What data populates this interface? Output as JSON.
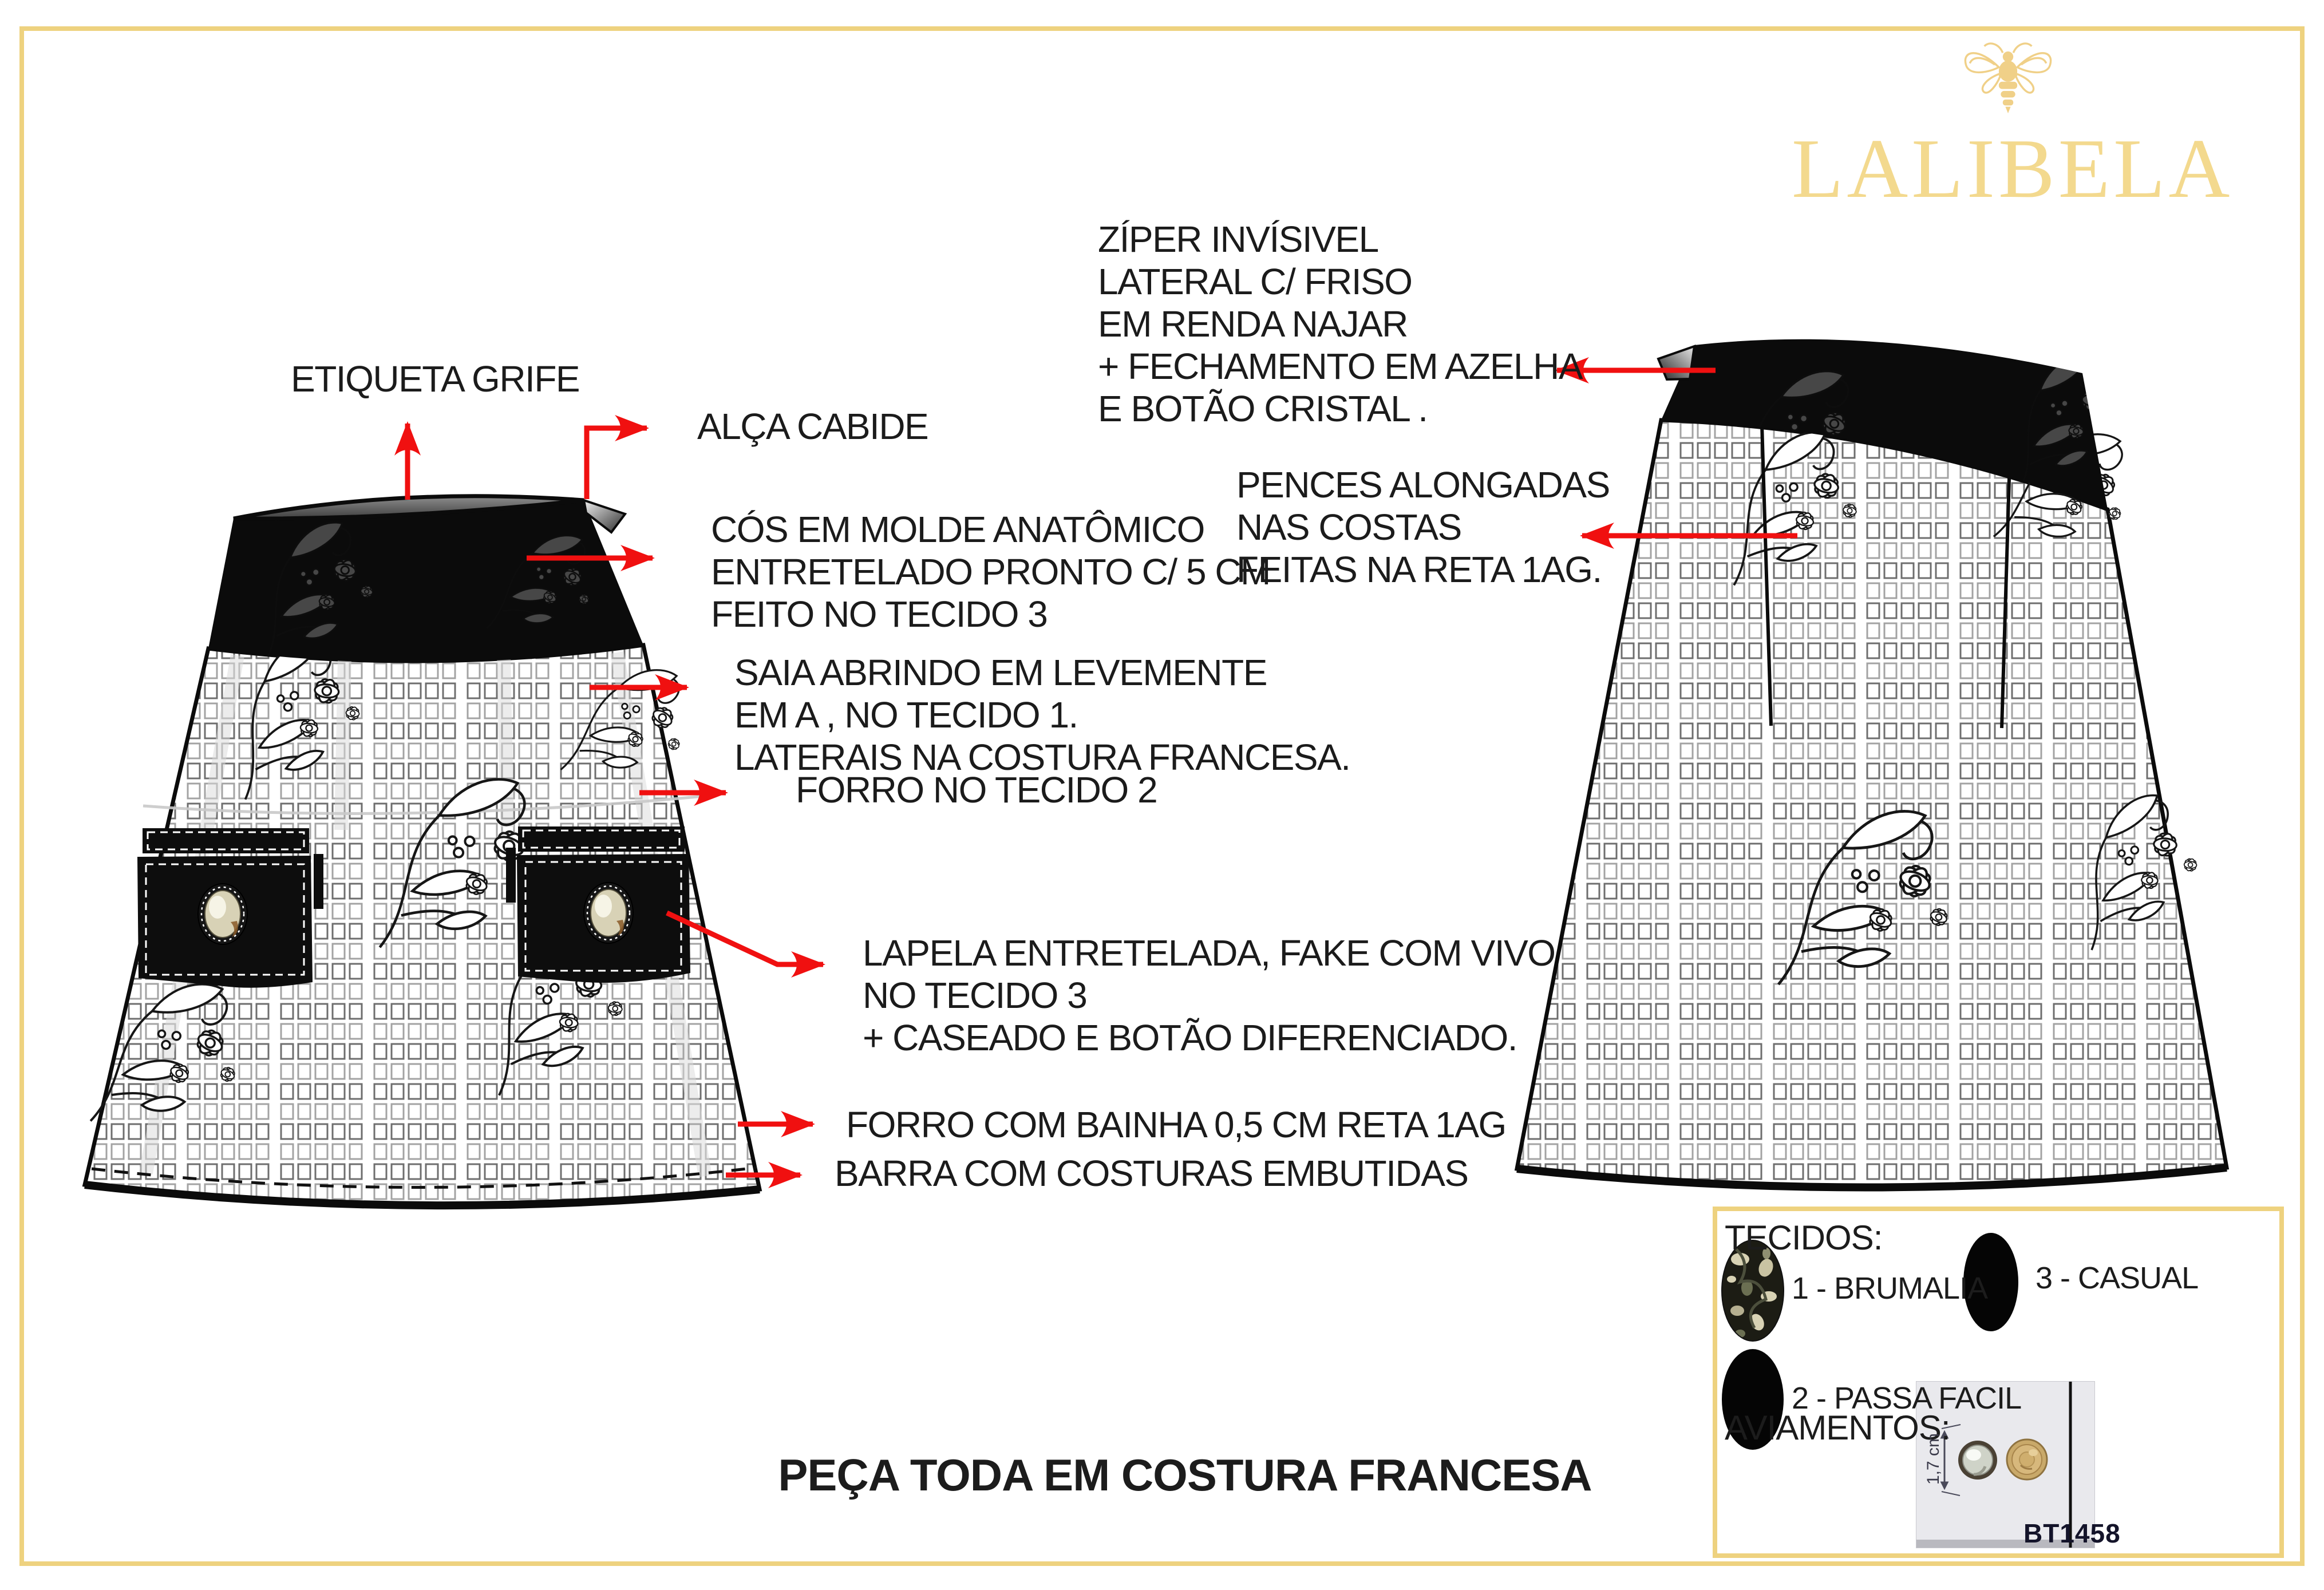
{
  "brand": {
    "name": "LALIBELA",
    "icon": "bee-icon",
    "gold": "#f3d98e"
  },
  "colors": {
    "arrow_red": "#f01010",
    "page_border": "#eed27f",
    "garment_black": "#0b0b0b"
  },
  "labels": {
    "etiqueta": "ETIQUETA GRIFE",
    "alca": "ALÇA CABIDE",
    "cos": "CÓS EM MOLDE ANATÔMICO\nENTRETELADO PRONTO C/ 5 CM\nFEITO NO TECIDO 3",
    "ziper": "ZÍPER INVÍSIVEL\nLATERAL C/ FRISO\nEM RENDA NAJAR\n+   FECHAMENTO EM AZELHA\nE BOTÃO CRISTAL .",
    "saia": "SAIA ABRINDO EM LEVEMENTE\nEM A , NO TECIDO 1.\nLATERAIS NA COSTURA FRANCESA.",
    "forro": "FORRO NO TECIDO 2",
    "pences": "PENCES ALONGADAS\nNAS COSTAS\nFEITAS NA RETA 1AG.",
    "lapela": "LAPELA ENTRETELADA, FAKE COM VIVO\nNO TECIDO 3\n+ CASEADO E BOTÃO DIFERENCIADO.",
    "forro_bainha": "FORRO COM BAINHA 0,5 CM RETA 1AG",
    "barra": "BARRA COM COSTURAS EMBUTIDAS"
  },
  "footer": {
    "text": "PEÇA TODA EM COSTURA FRANCESA"
  },
  "legend": {
    "title": "TECIDOS:",
    "items": [
      {
        "label": "1 - BRUMALIA",
        "swatch": "brumalia-print"
      },
      {
        "label": "3 - CASUAL",
        "swatch": "solid-black"
      },
      {
        "label": "2 - PASSA FACIL",
        "swatch": "solid-black"
      }
    ],
    "aviamentos_title": "AVIAMENTOS:",
    "button_code": "BT1458",
    "button_size": "1,7 cm"
  }
}
